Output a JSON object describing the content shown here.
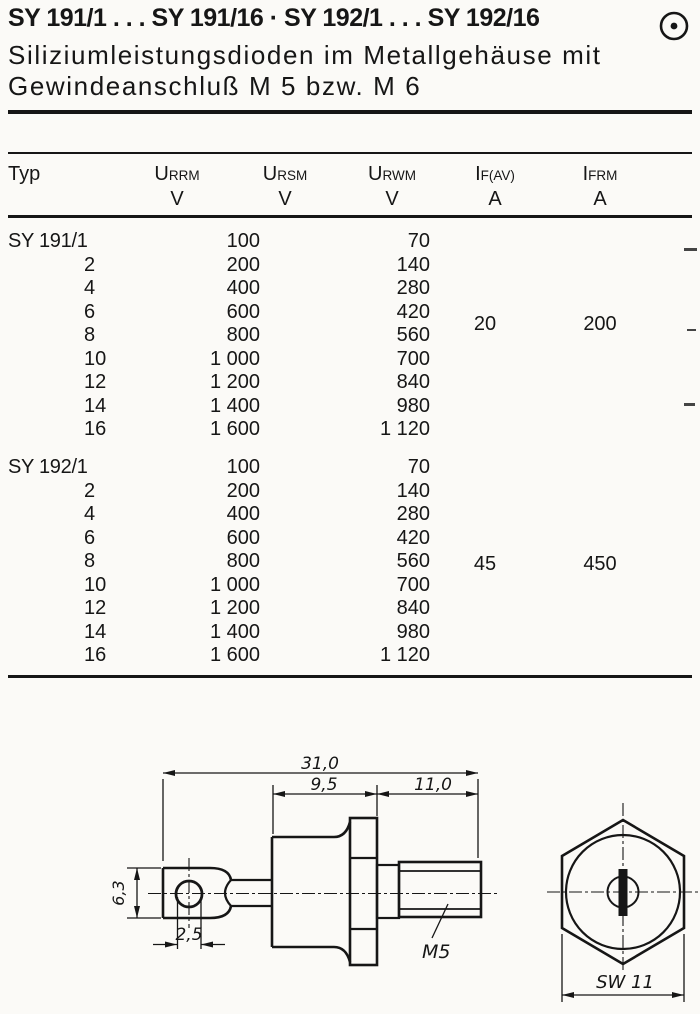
{
  "header": {
    "title": "SY 191/1 . . . SY 191/16 · SY 192/1 . . . SY 192/16",
    "subtitle_line1": "Siliziumleistungsdioden im Metallgehäuse mit",
    "subtitle_line2": "Gewindeanschluß M 5 bzw. M 6",
    "corner_icon": "circled-dot-icon"
  },
  "table": {
    "columns": {
      "typ": "Typ",
      "urrm": {
        "base": "U",
        "sub": "RRM",
        "unit": "V"
      },
      "ursm": {
        "base": "U",
        "sub": "RSM",
        "unit": "V"
      },
      "urwm": {
        "base": "U",
        "sub": "RWM",
        "unit": "V"
      },
      "ifav": {
        "base": "I",
        "sub": "F(AV)",
        "unit": "A"
      },
      "ifrm": {
        "base": "I",
        "sub": "FRM",
        "unit": "A"
      }
    },
    "groups": [
      {
        "rows": [
          {
            "typ": "SY 191/1",
            "v1": "100",
            "v2": "70"
          },
          {
            "typ": "2",
            "v1": "200",
            "v2": "140"
          },
          {
            "typ": "4",
            "v1": "400",
            "v2": "280"
          },
          {
            "typ": "6",
            "v1": "600",
            "v2": "420"
          },
          {
            "typ": "8",
            "v1": "800",
            "v2": "560"
          },
          {
            "typ": "10",
            "v1": "1 000",
            "v2": "700"
          },
          {
            "typ": "12",
            "v1": "1 200",
            "v2": "840"
          },
          {
            "typ": "14",
            "v1": "1 400",
            "v2": "980"
          },
          {
            "typ": "16",
            "v1": "1 600",
            "v2": "1 120"
          }
        ],
        "if_av": "20",
        "ifrm": "200"
      },
      {
        "rows": [
          {
            "typ": "SY 192/1",
            "v1": "100",
            "v2": "70"
          },
          {
            "typ": "2",
            "v1": "200",
            "v2": "140"
          },
          {
            "typ": "4",
            "v1": "400",
            "v2": "280"
          },
          {
            "typ": "6",
            "v1": "600",
            "v2": "420"
          },
          {
            "typ": "8",
            "v1": "800",
            "v2": "560"
          },
          {
            "typ": "10",
            "v1": "1 000",
            "v2": "700"
          },
          {
            "typ": "12",
            "v1": "1 200",
            "v2": "840"
          },
          {
            "typ": "14",
            "v1": "1 400",
            "v2": "980"
          },
          {
            "typ": "16",
            "v1": "1 600",
            "v2": "1 120"
          }
        ],
        "if_av": "45",
        "ifrm": "450"
      }
    ]
  },
  "drawing": {
    "side_view": {
      "dim_total": "31,0",
      "dim_body": "9,5",
      "dim_stud": "11,0",
      "dim_tab_height": "6,3",
      "dim_hole": "2,5",
      "thread_label": "M5"
    },
    "end_view": {
      "dim_wrench": "SW 11"
    }
  },
  "colors": {
    "ink": "#161616",
    "paper": "#fbfaf7"
  }
}
